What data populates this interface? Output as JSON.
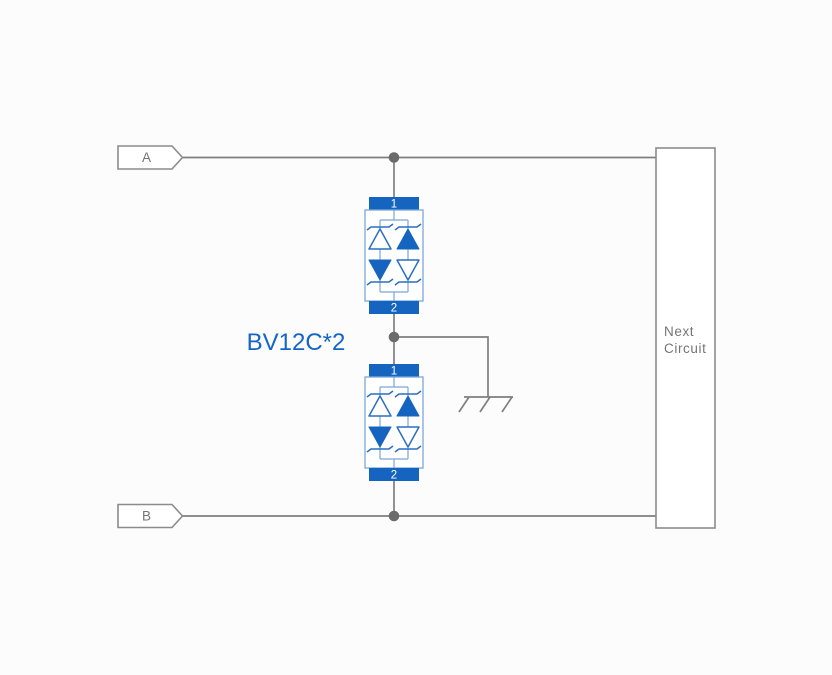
{
  "diagram": {
    "title": "TVS protection circuit schematic",
    "part_label": "BV12C*2",
    "net_tags": {
      "a": "A",
      "b": "B"
    },
    "component": {
      "pin1": "1",
      "pin2": "2"
    },
    "next_circuit": {
      "line1": "Next",
      "line2": "Circuit"
    },
    "colors": {
      "bg": "#fcfcfc",
      "wire": "#7f7f7f",
      "node": "#6b6b6b",
      "tag_stroke": "#8c8c8c",
      "text_gray": "#757575",
      "component_fill": "#1565c0",
      "component_outline": "#7aa7d9",
      "diode_stroke": "#2a6fc2",
      "label_blue": "#1565c8"
    }
  }
}
